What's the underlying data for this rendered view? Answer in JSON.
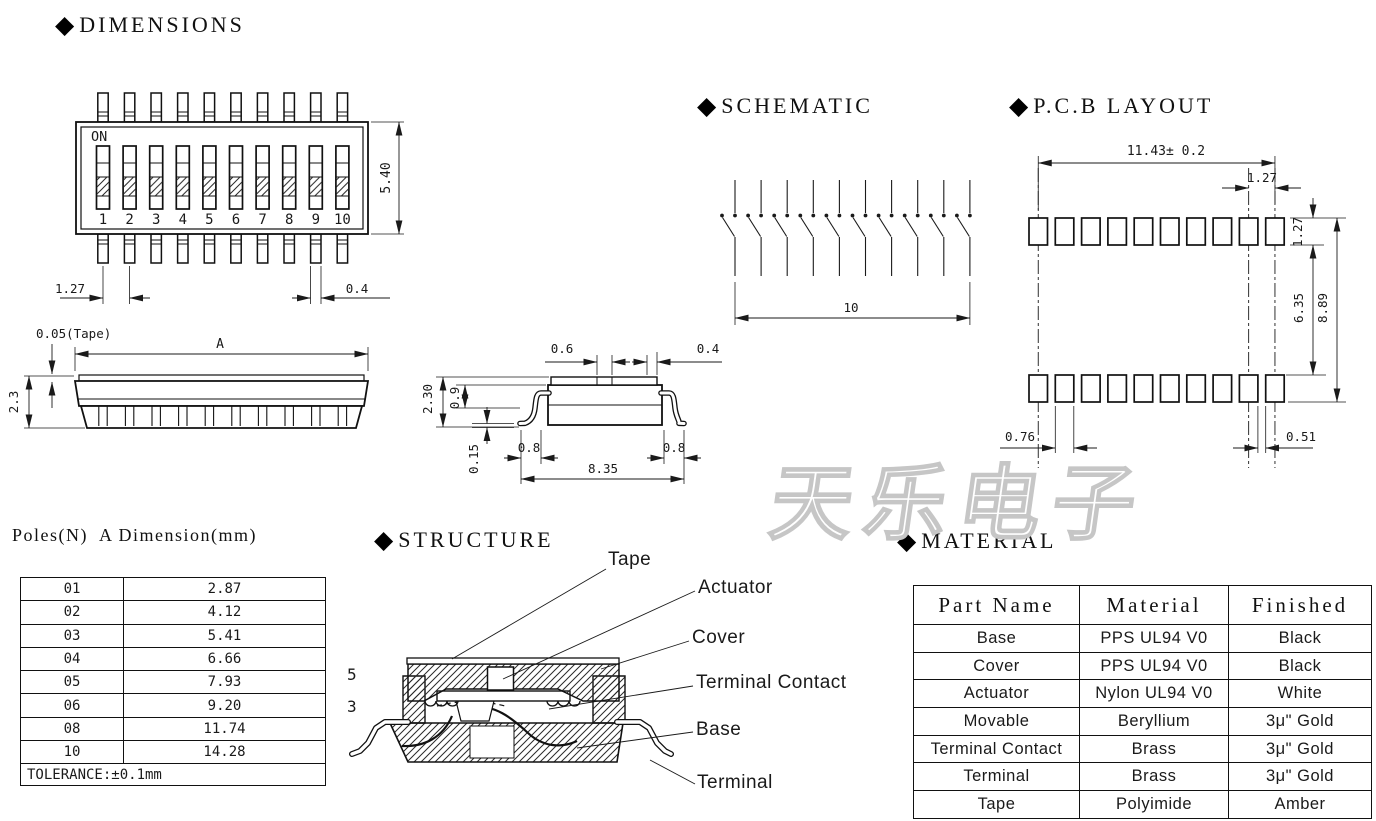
{
  "headings": {
    "diamond": "◆",
    "dimensions": "DIMENSIONS",
    "schematic": "SCHEMATIC",
    "pcb_layout": "P.C.B LAYOUT",
    "structure": "STRUCTURE",
    "material": "MATERIAL"
  },
  "top_view": {
    "on_label": "ON",
    "positions": [
      "1",
      "2",
      "3",
      "4",
      "5",
      "6",
      "7",
      "8",
      "9",
      "10"
    ],
    "dim_height": "5.40",
    "dim_pitch": "1.27",
    "dim_pin_width": "0.4"
  },
  "side_view": {
    "dim_tape": "0.05(Tape)",
    "dim_length": "A",
    "dim_height": "2.3"
  },
  "end_view": {
    "dim_slot": "0.6",
    "dim_edge": "0.4",
    "dim_height": "2.30",
    "dim_body": "0.9",
    "dim_standoff": "0.15",
    "dim_foot_left": "0.8",
    "dim_foot_right": "0.8",
    "dim_span": "8.35"
  },
  "schematic": {
    "dim_count": "10"
  },
  "pcb_layout": {
    "dim_span": "11.43± 0.2",
    "dim_pitch": "1.27",
    "dim_pad_height": "1.27",
    "dim_row_gap": "6.35",
    "dim_overall": "8.89",
    "dim_pad_width": "0.76",
    "dim_pad_gap": "0.51"
  },
  "poles_table": {
    "title": "Poles(N)  A Dimension(mm)",
    "rows": [
      [
        "01",
        "2.87"
      ],
      [
        "02",
        "4.12"
      ],
      [
        "03",
        "5.41"
      ],
      [
        "04",
        "6.66"
      ],
      [
        "05",
        "7.93"
      ],
      [
        "06",
        "9.20"
      ],
      [
        "08",
        "11.74"
      ],
      [
        "10",
        "14.28"
      ]
    ],
    "tolerance": "TOLERANCE:±0.1mm"
  },
  "structure": {
    "labels": {
      "tape": "Tape",
      "actuator": "Actuator",
      "cover": "Cover",
      "terminal_contact": "Terminal Contact",
      "base": "Base",
      "terminal": "Terminal"
    },
    "callout_5": "5",
    "callout_3": "3"
  },
  "material_table": {
    "headers": [
      "Part Name",
      "Material",
      "Finished"
    ],
    "rows": [
      [
        "Base",
        "PPS UL94 V0",
        "Black"
      ],
      [
        "Cover",
        "PPS UL94 V0",
        "Black"
      ],
      [
        "Actuator",
        "Nylon UL94 V0",
        "White"
      ],
      [
        "Movable",
        "Beryllium",
        "3μ\" Gold"
      ],
      [
        "Terminal Contact",
        "Brass",
        "3μ\" Gold"
      ],
      [
        "Terminal",
        "Brass",
        "3μ\" Gold"
      ],
      [
        "Tape",
        "Polyimide",
        "Amber"
      ]
    ]
  },
  "watermark": "天乐电子"
}
